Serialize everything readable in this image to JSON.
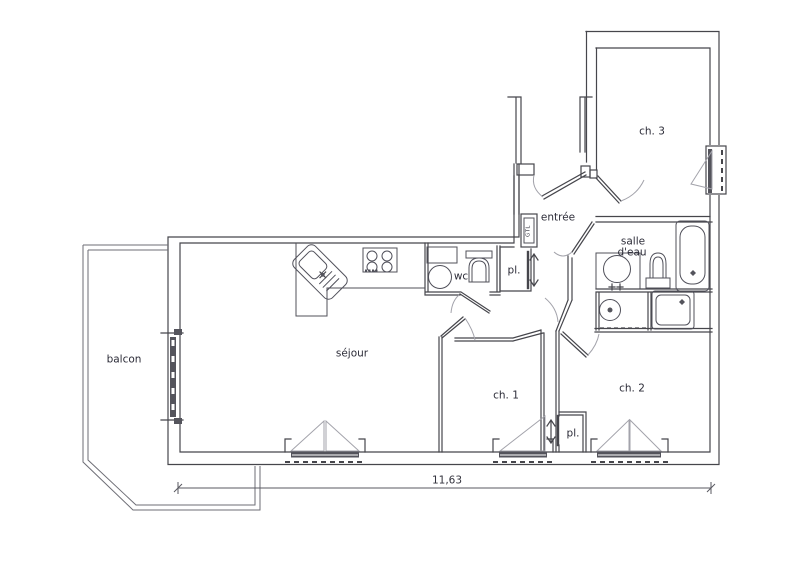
{
  "labels": {
    "ch3": "ch. 3",
    "entree": "entrée",
    "salle_eau_1": "salle",
    "salle_eau_2": "d'eau",
    "wc": "wc",
    "pl_entree": "pl.",
    "gtl": "GTL",
    "balcon": "balcon",
    "sejour": "séjour",
    "ch1": "ch. 1",
    "ch2": "ch. 2",
    "pl_ch2": "pl."
  },
  "dimension": {
    "overall_width": "11,63"
  },
  "colors": {
    "walls": "#46464c",
    "light_lines": "#a3a3ab",
    "balcony_lines": "#6e6e76",
    "glazing_fill": "#54545c",
    "label_text": "#2c2c38",
    "background": "#ffffff"
  }
}
